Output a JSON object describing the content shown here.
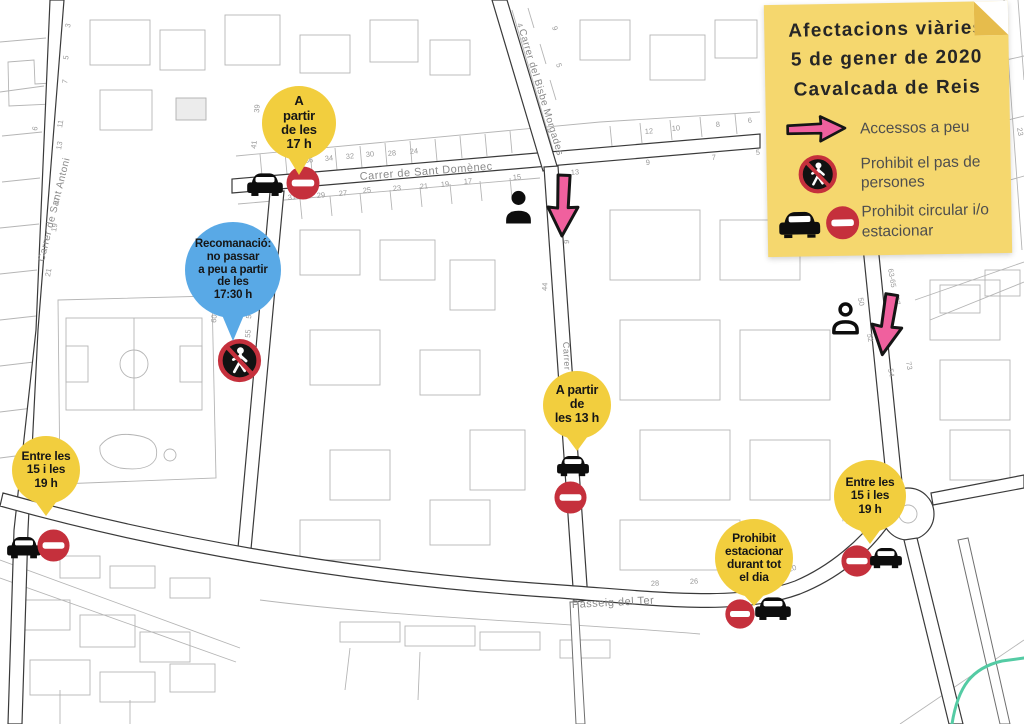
{
  "title": "Afectacions viàries 5 de gener de 2020 Cavalcada de Reis",
  "legend": {
    "title_lines": [
      "Afectacions viàries",
      "5 de gener de 2020",
      "Cavalcada de Reis"
    ],
    "items": [
      {
        "icon": "pink-arrow-icon",
        "label": "Accessos a peu"
      },
      {
        "icon": "no-pedestrian-sign-icon",
        "label": "Prohibit el pas de persones"
      },
      {
        "icon": "car-no-entry-icon",
        "label": "Prohibit circular i/o estacionar"
      }
    ]
  },
  "pins": {
    "partir17": {
      "color": "yellow",
      "text": "A\npartir\nde les\n17  h",
      "icons": [
        "car-icon",
        "no-entry-sign-icon"
      ]
    },
    "recomanacio": {
      "color": "blue",
      "text": "Recomanació:\nno passar\na peu a partir\nde les\n17:30 h",
      "icons": [
        "no-pedestrian-sign-icon"
      ]
    },
    "partir13": {
      "color": "yellow",
      "text": "A partir\nde\nles 13  h",
      "icons": [
        "car-icon",
        "no-entry-sign-icon"
      ]
    },
    "entreWest": {
      "color": "yellow",
      "text": "Entre les\n15 i les\n19  h",
      "icons": [
        "car-icon",
        "no-entry-sign-icon"
      ]
    },
    "estacionar": {
      "color": "yellow",
      "text": "Prohibit\nestacionar\ndurant tot\nel dia",
      "icons": [
        "no-entry-sign-icon",
        "car-icon"
      ]
    },
    "entreEast": {
      "color": "yellow",
      "text": "Entre les\n15 i les\n19  h",
      "icons": [
        "no-entry-sign-icon",
        "car-icon"
      ]
    }
  },
  "map": {
    "street_labels": {
      "santDomenec": "Carrer de Sant Domènec",
      "bisbeMorgades": "Carrer del Bisbe Morgades",
      "santAntoni": "Carrer de Sant Antoni",
      "passeigTer": "Passeig del Ter",
      "carrerCenter": "Carrer"
    },
    "house_numbers": [
      {
        "t": "36",
        "x": 305,
        "y": 163,
        "r": -5
      },
      {
        "t": "34",
        "x": 325,
        "y": 161,
        "r": -5
      },
      {
        "t": "32",
        "x": 346,
        "y": 159,
        "r": -5
      },
      {
        "t": "30",
        "x": 366,
        "y": 157,
        "r": -5
      },
      {
        "t": "28",
        "x": 388,
        "y": 156,
        "r": -5
      },
      {
        "t": "24",
        "x": 410,
        "y": 154,
        "r": -5
      },
      {
        "t": "12",
        "x": 645,
        "y": 134,
        "r": -5
      },
      {
        "t": "10",
        "x": 672,
        "y": 131,
        "r": -5
      },
      {
        "t": "8",
        "x": 716,
        "y": 127,
        "r": -5
      },
      {
        "t": "6",
        "x": 748,
        "y": 123,
        "r": -5
      },
      {
        "t": "31",
        "x": 288,
        "y": 200,
        "r": -5
      },
      {
        "t": "29",
        "x": 317,
        "y": 198,
        "r": -5
      },
      {
        "t": "27",
        "x": 339,
        "y": 196,
        "r": -5
      },
      {
        "t": "25",
        "x": 363,
        "y": 193,
        "r": -5
      },
      {
        "t": "23",
        "x": 393,
        "y": 191,
        "r": -5
      },
      {
        "t": "21",
        "x": 420,
        "y": 189,
        "r": -5
      },
      {
        "t": "19",
        "x": 441,
        "y": 187,
        "r": -5
      },
      {
        "t": "17",
        "x": 464,
        "y": 184,
        "r": -5
      },
      {
        "t": "15",
        "x": 513,
        "y": 180,
        "r": -5
      },
      {
        "t": "9",
        "x": 646,
        "y": 165,
        "r": -5
      },
      {
        "t": "7",
        "x": 712,
        "y": 160,
        "r": -5
      },
      {
        "t": "5",
        "x": 756,
        "y": 155,
        "r": -5
      },
      {
        "t": "3",
        "x": 70,
        "y": 28,
        "r": -80
      },
      {
        "t": "5",
        "x": 68,
        "y": 60,
        "r": -80
      },
      {
        "t": "7",
        "x": 67,
        "y": 84,
        "r": -80
      },
      {
        "t": "11",
        "x": 62,
        "y": 128,
        "r": -80
      },
      {
        "t": "13",
        "x": 61,
        "y": 150,
        "r": -80
      },
      {
        "t": "17",
        "x": 58,
        "y": 206,
        "r": -80
      },
      {
        "t": "19",
        "x": 56,
        "y": 232,
        "r": -80
      },
      {
        "t": "21",
        "x": 50,
        "y": 277,
        "r": -80
      },
      {
        "t": "6",
        "x": 37,
        "y": 131,
        "r": -80
      },
      {
        "t": "39",
        "x": 259,
        "y": 113,
        "r": -84
      },
      {
        "t": "41",
        "x": 256,
        "y": 149,
        "r": -84
      },
      {
        "t": "60",
        "x": 216,
        "y": 323,
        "r": -84
      },
      {
        "t": "53",
        "x": 251,
        "y": 319,
        "r": -84
      },
      {
        "t": "55",
        "x": 250,
        "y": 338,
        "r": -84
      },
      {
        "t": "4",
        "x": 517,
        "y": 24,
        "r": 73
      },
      {
        "t": "9",
        "x": 552,
        "y": 27,
        "r": 73
      },
      {
        "t": "5",
        "x": 556,
        "y": 64,
        "r": 73
      },
      {
        "t": "13",
        "x": 571,
        "y": 175,
        "r": -5
      },
      {
        "t": "44",
        "x": 547,
        "y": 291,
        "r": -87
      },
      {
        "t": "9",
        "x": 569,
        "y": 244,
        "r": -87
      },
      {
        "t": "28",
        "x": 651,
        "y": 586,
        "r": -3
      },
      {
        "t": "26",
        "x": 690,
        "y": 584,
        "r": -3
      },
      {
        "t": "24",
        "x": 727,
        "y": 582,
        "r": -3
      },
      {
        "t": "20",
        "x": 789,
        "y": 572,
        "r": -18
      },
      {
        "t": "16",
        "x": 846,
        "y": 524,
        "r": -60
      },
      {
        "t": "63-65",
        "x": 888,
        "y": 269,
        "r": 80
      },
      {
        "t": "67",
        "x": 894,
        "y": 297,
        "r": 80
      },
      {
        "t": "50",
        "x": 858,
        "y": 298,
        "r": 80
      },
      {
        "t": "52",
        "x": 867,
        "y": 334,
        "r": 80
      },
      {
        "t": "54",
        "x": 888,
        "y": 369,
        "r": 80
      },
      {
        "t": "73",
        "x": 906,
        "y": 362,
        "r": 80
      },
      {
        "t": "31",
        "x": 1000,
        "y": 23,
        "r": 80
      },
      {
        "t": "23",
        "x": 1017,
        "y": 128,
        "r": 80
      }
    ]
  },
  "colors": {
    "legend_yellow": "#f5d76e",
    "pin_yellow": "#f2ce3e",
    "pin_blue": "#59a9e6",
    "arrow_pink": "#f0609e",
    "sign_red": "#c5303c",
    "river_teal": "#54cba4"
  }
}
